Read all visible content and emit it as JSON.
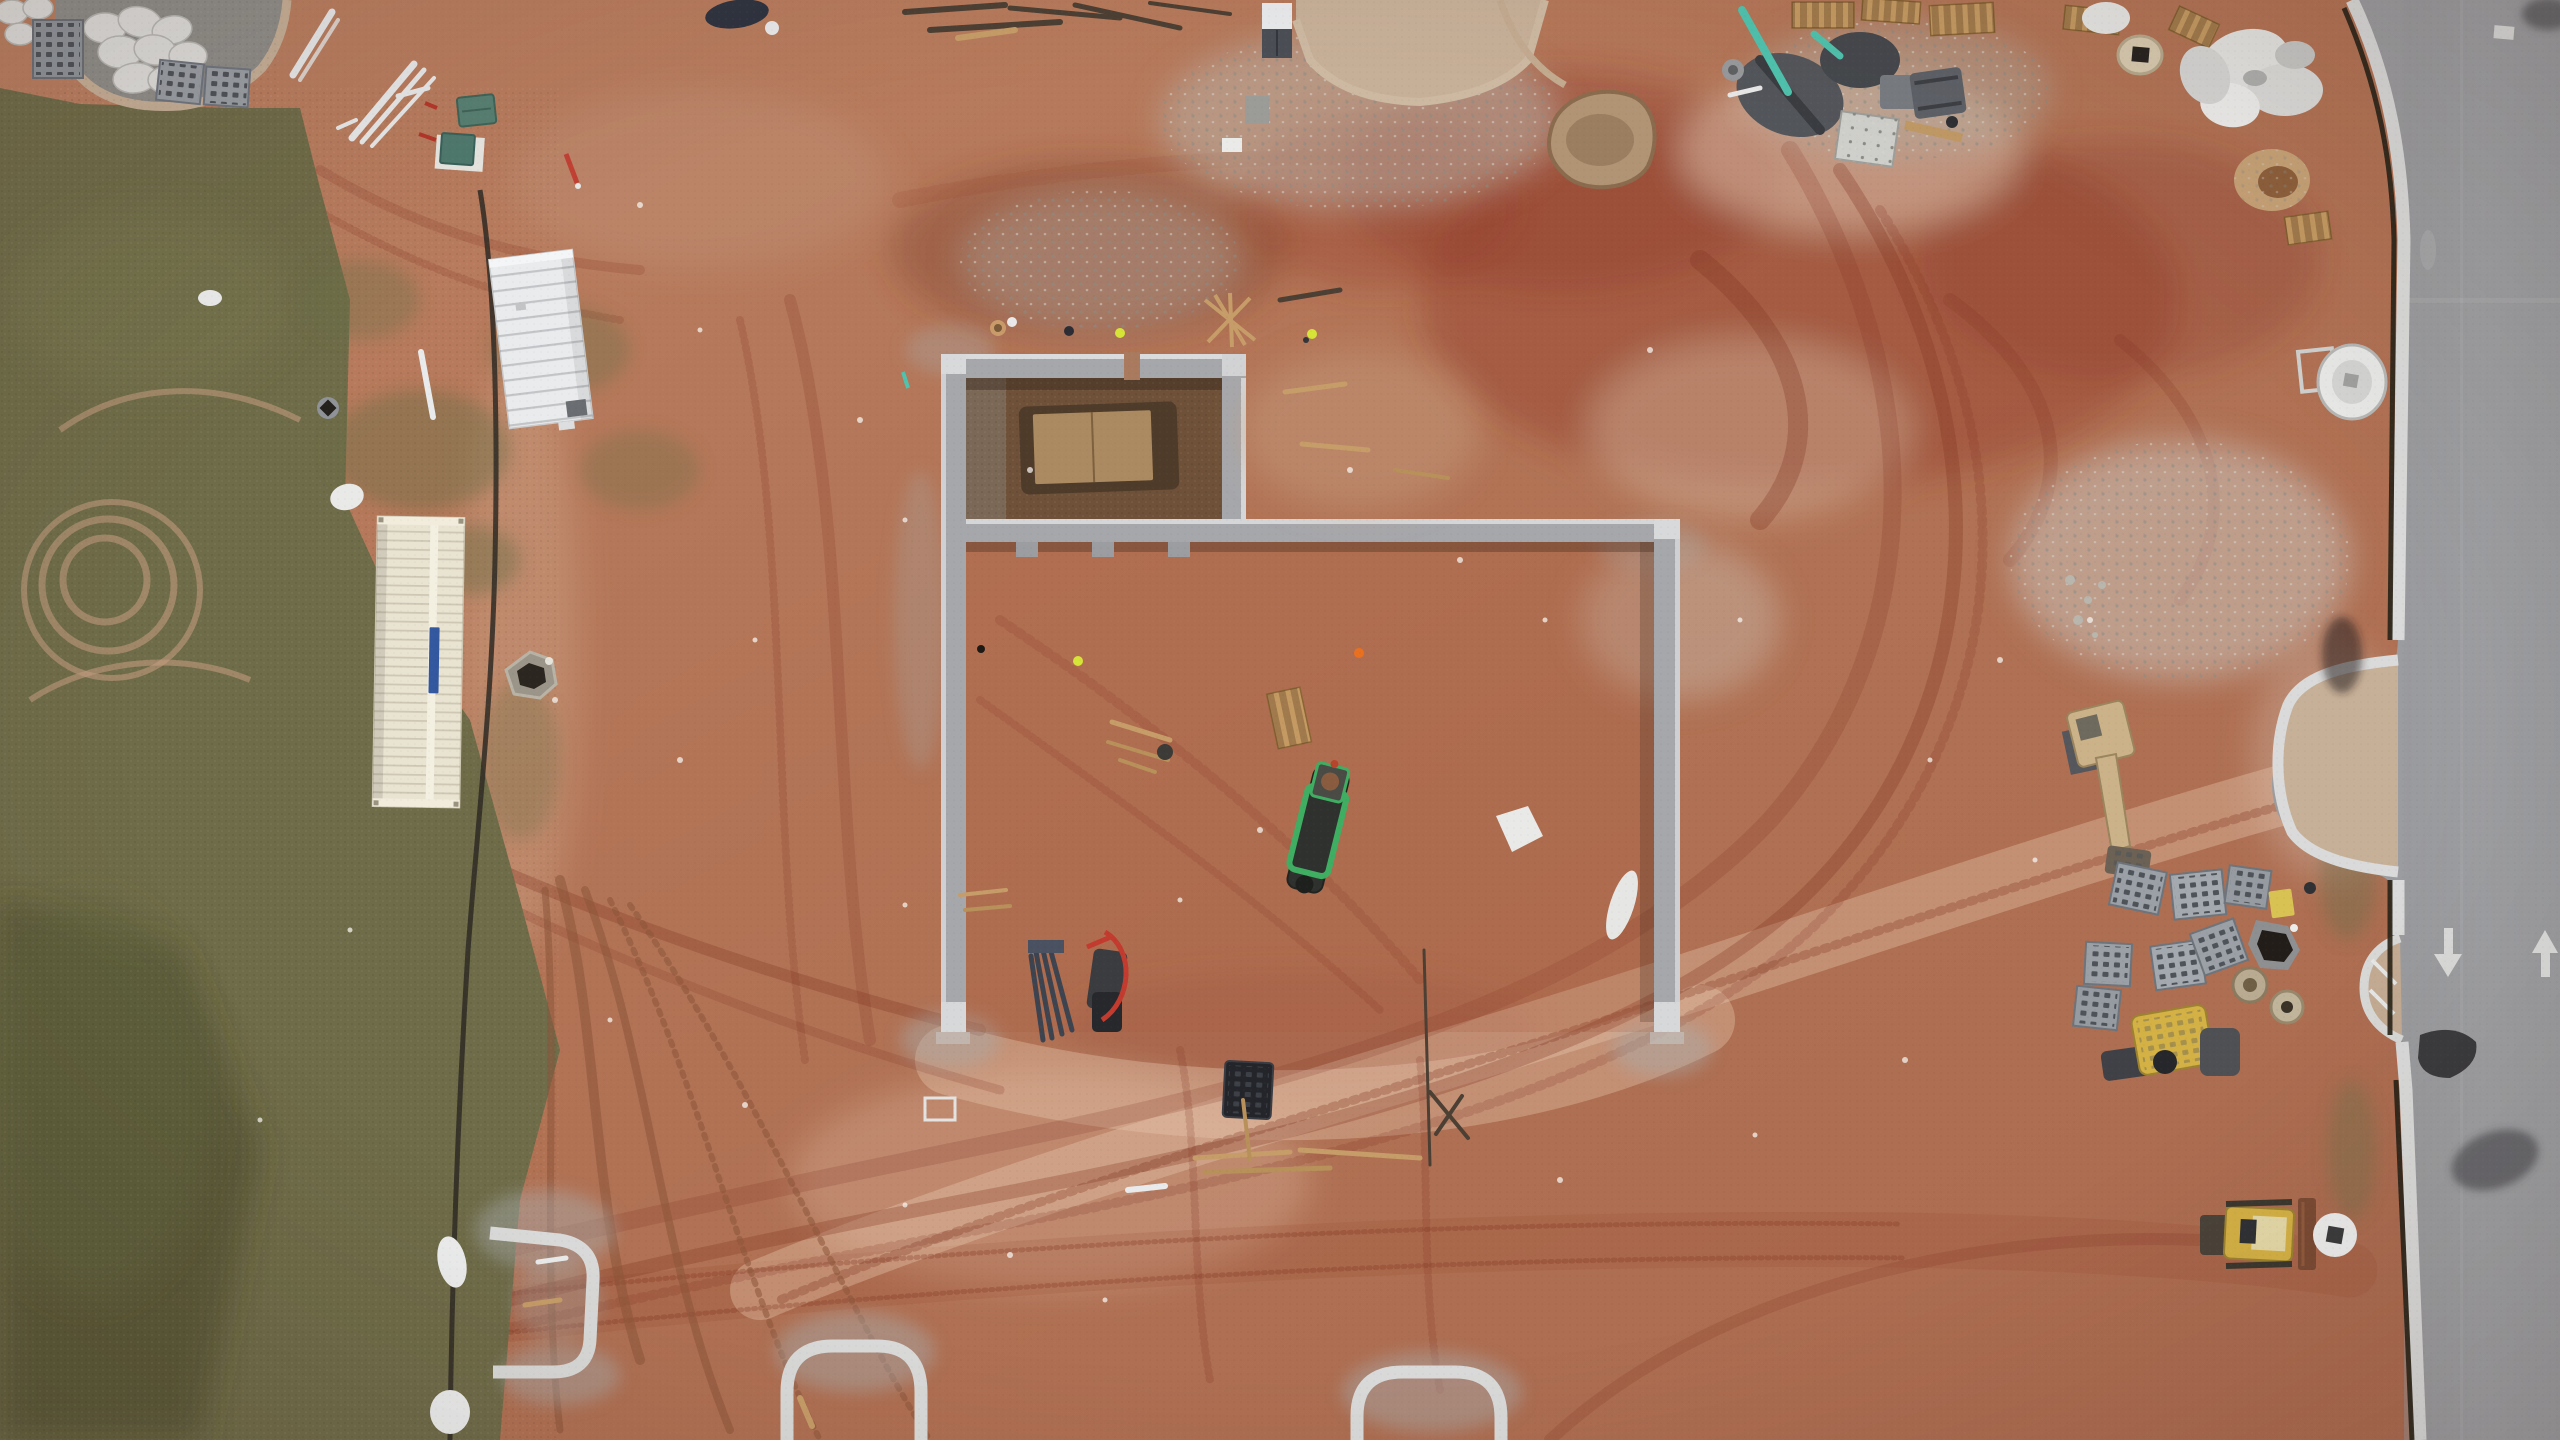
{
  "scene": {
    "title": "Aerial drone photograph of a construction site",
    "description": "Overhead view: poured concrete foundation walls on red clay, office trailer and storage container at left on grass, equipment and material staging at top right, finished road with painted arrows on right, curb islands under construction at bottom",
    "objects": [
      "concrete-foundation-walls",
      "excavated-pit-with-plywood-cover",
      "office-trailer",
      "storage-container",
      "silt-fence",
      "mud-pond",
      "asphalt-road",
      "driveway-apron",
      "lane-arrows",
      "excavator",
      "bulldozer",
      "compactor",
      "tracked-mini-dumper",
      "grate-stacks",
      "manhole-rings",
      "wood-pallets",
      "sandbags",
      "utility-boxes",
      "workers",
      "tire-tracks",
      "grass-field",
      "curb-islands",
      "white-pipes",
      "trash-pile",
      "water-tank"
    ]
  },
  "colors": {
    "dirt": "#b2765a",
    "dirt_dark": "#94503a",
    "dirt_light": "#cf9c7f",
    "clay_track": "#8c4631",
    "grass": "#6f6c49",
    "road": "#9b9c9f",
    "curb": "#d9dad9",
    "apron": "#c7b098",
    "wall": "#a6a7ab",
    "wall_light": "#d8d9db",
    "trailer_white": "#eaebec",
    "container_cream": "#e9e3d2",
    "container_logo": "#33589f",
    "machine_green": "#3fae62",
    "machine_yellow": "#d4b145",
    "excavator_tan": "#cbb289",
    "teal_box": "#578073",
    "pond": "#b19474",
    "gravel": "#c2bcb1",
    "safety_orange": "#e8701f",
    "safety_lime": "#d6e337",
    "pipe_teal": "#4fc3ae",
    "plywood": "#ac8a61",
    "pit_dark": "#4f3b29"
  }
}
